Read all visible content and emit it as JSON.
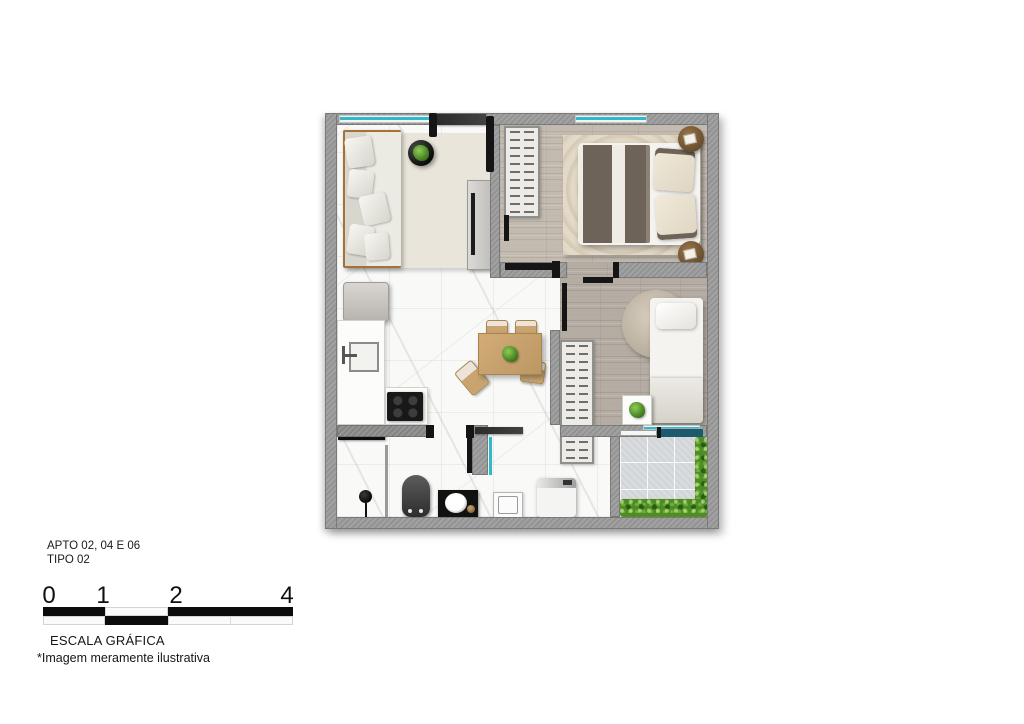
{
  "floor_plan": {
    "apartment_label": "APTO 02, 04 E 06",
    "type_label": "TIPO 02",
    "rooms": [
      "living-room",
      "bedroom-1",
      "bedroom-2",
      "kitchen",
      "bathroom",
      "laundry",
      "balcony"
    ],
    "furniture_icons": [
      "sofa",
      "coffee-table-plant",
      "tv-console",
      "wardrobe",
      "double-bed",
      "nightstand",
      "single-bed",
      "side-table-plant",
      "dining-table",
      "dining-chair",
      "refrigerator",
      "kitchen-counter",
      "kitchen-sink",
      "cooktop",
      "toilet",
      "shower-head",
      "shower-niche",
      "vanity-sink",
      "laundry-tank",
      "washing-machine",
      "hedge"
    ]
  },
  "scale_bar": {
    "ticks": [
      "0",
      "1",
      "2",
      "4"
    ],
    "label": "ESCALA GRÁFICA"
  },
  "disclaimer": "*Imagem meramente ilustrativa",
  "colors": {
    "wall_gray": "#9b9b9b",
    "marble_floor": "#f9f9f8",
    "wood_floor": "#bdb5aa",
    "balcony_tile": "#d9dcde",
    "window_glass": "#2fb9cd",
    "slider_glass": "#1c5b6e",
    "hedge_green": "#4e8c26",
    "blanket_taupe": "#6e6358",
    "table_wood": "#c9a471",
    "accent_black": "#151515"
  }
}
